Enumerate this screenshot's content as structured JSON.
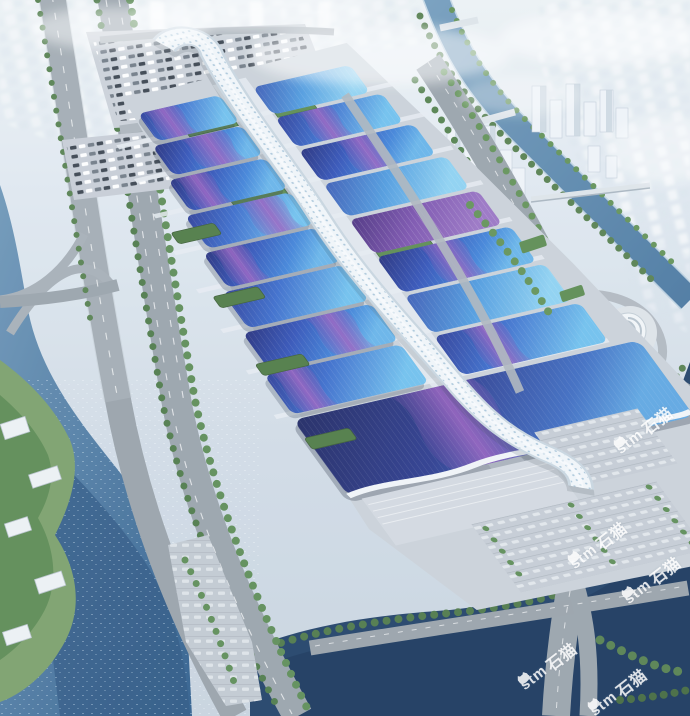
{
  "scene_type": "aerial-rendering-exhibition-center",
  "watermark": {
    "icon": "cat-logo-icon",
    "brand": "stm",
    "brand_cjk": "石猫",
    "color": "#ffffff"
  },
  "palette": {
    "roof_deep_blue": "#2a3580",
    "roof_blue": "#3a6cd0",
    "roof_cyan": "#57aae6",
    "roof_purple": "#7b52ae",
    "roof_navy": "#252c6e",
    "swath_purple": "#8a56b4",
    "spine_white": "#f2f7fa",
    "water_river": "#4b7ba8",
    "water_dark": "#1f3f66",
    "road_asphalt": "#9aa3ab",
    "tree_green": "#53804c",
    "ground_plaza": "#ccd3da",
    "haze_city": "#e9eff4"
  }
}
